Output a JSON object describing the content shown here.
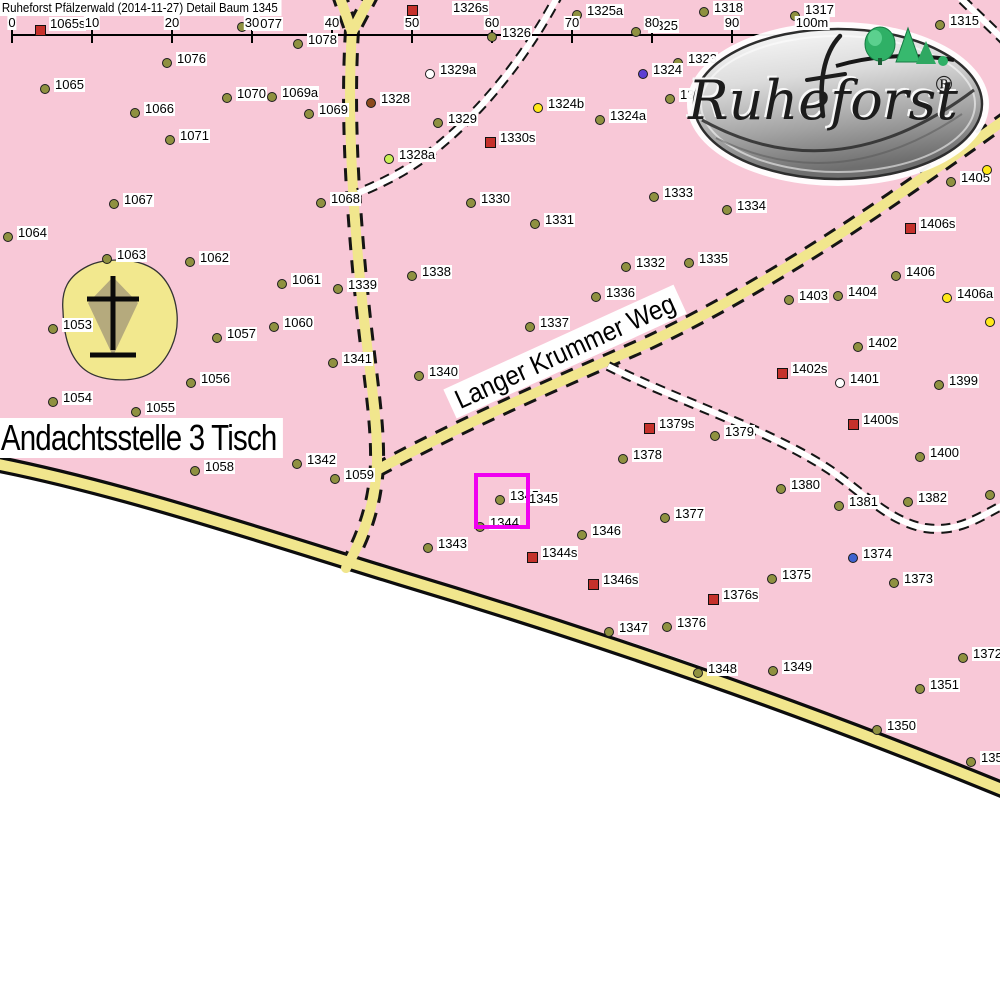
{
  "header": {
    "title": "Ruheforst Pfälzerwald (2014-11-27) Detail  Baum 1345"
  },
  "labels": {
    "place": "Andachtsstelle 3 Tisch",
    "street": "Langer Krummer Weg"
  },
  "logo": {
    "brand": "Ruheforst",
    "registered": "®"
  },
  "selected_tree": "1345",
  "highlight_box": {
    "x": 474,
    "y": 473,
    "w": 48,
    "h": 48,
    "color": "#f000f0"
  },
  "colors": {
    "forest_fill": "#f8c8d7",
    "road_fill": "#f1e68d",
    "highlight": "#f000f0",
    "label_bg": "#ffffff",
    "marker_colors": {
      "t": "#8f9140",
      "s": "#c5312b",
      "y": "#ffe81a",
      "yg": "#c9ef55",
      "w": "#ffffff",
      "br": "#8b4a1c",
      "pu": "#5d3fd3",
      "bl": "#3f63cf"
    }
  },
  "scalebar": {
    "line": {
      "x1": 12,
      "x2": 812,
      "y": 34
    },
    "ticks": [
      {
        "label": "0",
        "x": 12
      },
      {
        "label": "10",
        "x": 92
      },
      {
        "label": "20",
        "x": 172
      },
      {
        "label": "30",
        "x": 252
      },
      {
        "label": "40",
        "x": 332
      },
      {
        "label": "50",
        "x": 412
      },
      {
        "label": "60",
        "x": 492
      },
      {
        "label": "70",
        "x": 572
      },
      {
        "label": "80",
        "x": 652
      },
      {
        "label": "90",
        "x": 732
      },
      {
        "label": "100m",
        "x": 812
      }
    ]
  },
  "trees": [
    {
      "id": "1065s",
      "x": 40,
      "y": 30,
      "t": "s",
      "lx": 49,
      "ly": 17
    },
    {
      "id": "1077",
      "x": 242,
      "y": 27,
      "t": "t",
      "lx": 252,
      "ly": 17
    },
    {
      "id": "1078",
      "x": 298,
      "y": 44,
      "t": "t"
    },
    {
      "id": "1076",
      "x": 167,
      "y": 63,
      "t": "t"
    },
    {
      "id": "1065",
      "x": 45,
      "y": 89,
      "t": "t"
    },
    {
      "id": "1066",
      "x": 135,
      "y": 113,
      "t": "t"
    },
    {
      "id": "1070",
      "x": 227,
      "y": 98,
      "t": "t"
    },
    {
      "id": "1069a",
      "x": 272,
      "y": 97,
      "t": "t"
    },
    {
      "id": "1069",
      "x": 309,
      "y": 114,
      "t": "t"
    },
    {
      "id": "1071",
      "x": 170,
      "y": 140,
      "t": "t"
    },
    {
      "id": "1067",
      "x": 114,
      "y": 204,
      "t": "t"
    },
    {
      "id": "1064",
      "x": 8,
      "y": 237,
      "t": "t"
    },
    {
      "id": "1063",
      "x": 107,
      "y": 259,
      "t": "t"
    },
    {
      "id": "1062",
      "x": 190,
      "y": 262,
      "t": "t"
    },
    {
      "id": "1061",
      "x": 282,
      "y": 284,
      "t": "t"
    },
    {
      "id": "1060",
      "x": 274,
      "y": 327,
      "t": "t"
    },
    {
      "id": "1053",
      "x": 53,
      "y": 329,
      "t": "t"
    },
    {
      "id": "1057",
      "x": 217,
      "y": 338,
      "t": "t"
    },
    {
      "id": "1056",
      "x": 191,
      "y": 383,
      "t": "t"
    },
    {
      "id": "1054",
      "x": 53,
      "y": 402,
      "t": "t"
    },
    {
      "id": "1055",
      "x": 136,
      "y": 412,
      "t": "t"
    },
    {
      "id": "1058",
      "x": 195,
      "y": 471,
      "t": "t"
    },
    {
      "id": "1342",
      "x": 297,
      "y": 464,
      "t": "t"
    },
    {
      "id": "1059",
      "x": 335,
      "y": 479,
      "t": "t"
    },
    {
      "id": "1326s",
      "x": 412,
      "y": 10,
      "t": "s",
      "lx": 452,
      "ly": 1
    },
    {
      "id": "1326",
      "x": 492,
      "y": 37,
      "t": "t"
    },
    {
      "id": "1329a",
      "x": 430,
      "y": 74,
      "t": "w"
    },
    {
      "id": "1328",
      "x": 371,
      "y": 103,
      "t": "br"
    },
    {
      "id": "1329",
      "x": 438,
      "y": 123,
      "t": "t"
    },
    {
      "id": "1324b",
      "x": 538,
      "y": 108,
      "t": "y"
    },
    {
      "id": "1330s",
      "x": 490,
      "y": 142,
      "t": "s"
    },
    {
      "id": "1328a",
      "x": 389,
      "y": 159,
      "t": "yg"
    },
    {
      "id": "1068",
      "x": 321,
      "y": 203,
      "t": "t"
    },
    {
      "id": "1330",
      "x": 471,
      "y": 203,
      "t": "t"
    },
    {
      "id": "1331",
      "x": 535,
      "y": 224,
      "t": "t"
    },
    {
      "id": "1325a",
      "x": 577,
      "y": 15,
      "t": "t"
    },
    {
      "id": "1325",
      "x": 636,
      "y": 32,
      "t": "t",
      "lx": 648,
      "ly": 19
    },
    {
      "id": "1318",
      "x": 704,
      "y": 12,
      "t": "t"
    },
    {
      "id": "1317",
      "x": 795,
      "y": 16,
      "t": "t",
      "lx": 804,
      "ly": 3
    },
    {
      "id": "1315",
      "x": 940,
      "y": 25,
      "t": "t"
    },
    {
      "id": "1323",
      "x": 678,
      "y": 63,
      "t": "t"
    },
    {
      "id": "1324",
      "x": 643,
      "y": 74,
      "t": "pu"
    },
    {
      "id": "1321",
      "x": 670,
      "y": 99,
      "t": "t"
    },
    {
      "id": "1324a",
      "x": 600,
      "y": 120,
      "t": "t"
    },
    {
      "id": "1333",
      "x": 654,
      "y": 197,
      "t": "t"
    },
    {
      "id": "1334",
      "x": 727,
      "y": 210,
      "t": "t"
    },
    {
      "id": "1405",
      "x": 951,
      "y": 182,
      "t": "t"
    },
    {
      "id": "",
      "x": 987,
      "y": 170,
      "t": "y"
    },
    {
      "id": "1406s",
      "x": 910,
      "y": 228,
      "t": "s"
    },
    {
      "id": "1332",
      "x": 626,
      "y": 267,
      "t": "t"
    },
    {
      "id": "1335",
      "x": 689,
      "y": 263,
      "t": "t"
    },
    {
      "id": "1338",
      "x": 412,
      "y": 276,
      "t": "t"
    },
    {
      "id": "1339",
      "x": 338,
      "y": 289,
      "t": "t"
    },
    {
      "id": "1336",
      "x": 596,
      "y": 297,
      "t": "t"
    },
    {
      "id": "1406",
      "x": 896,
      "y": 276,
      "t": "t"
    },
    {
      "id": "1403",
      "x": 789,
      "y": 300,
      "t": "t"
    },
    {
      "id": "1404",
      "x": 838,
      "y": 296,
      "t": "t"
    },
    {
      "id": "1406a",
      "x": 947,
      "y": 298,
      "t": "y"
    },
    {
      "id": "",
      "x": 990,
      "y": 322,
      "t": "y"
    },
    {
      "id": "1337",
      "x": 530,
      "y": 327,
      "t": "t"
    },
    {
      "id": "1402",
      "x": 858,
      "y": 347,
      "t": "t"
    },
    {
      "id": "1341",
      "x": 333,
      "y": 363,
      "t": "t"
    },
    {
      "id": "1340",
      "x": 419,
      "y": 376,
      "t": "t"
    },
    {
      "id": "1402s",
      "x": 782,
      "y": 373,
      "t": "s"
    },
    {
      "id": "1401",
      "x": 840,
      "y": 383,
      "t": "w"
    },
    {
      "id": "1399",
      "x": 939,
      "y": 385,
      "t": "t"
    },
    {
      "id": "1379s",
      "x": 649,
      "y": 428,
      "t": "s"
    },
    {
      "id": "1379",
      "x": 715,
      "y": 436,
      "t": "t"
    },
    {
      "id": "1400s",
      "x": 853,
      "y": 424,
      "t": "s"
    },
    {
      "id": "1378",
      "x": 623,
      "y": 459,
      "t": "t"
    },
    {
      "id": "1400",
      "x": 920,
      "y": 457,
      "t": "t"
    },
    {
      "id": "1380",
      "x": 781,
      "y": 489,
      "t": "t"
    },
    {
      "id": "1381",
      "x": 839,
      "y": 506,
      "t": "t"
    },
    {
      "id": "1382",
      "x": 908,
      "y": 502,
      "t": "t"
    },
    {
      "id": "",
      "x": 990,
      "y": 495,
      "t": "t"
    },
    {
      "id": "1343",
      "x": 428,
      "y": 548,
      "t": "t"
    },
    {
      "id": "1344",
      "x": 480,
      "y": 527,
      "t": "t"
    },
    {
      "id": "1345",
      "x": 500,
      "y": 500,
      "t": "t"
    },
    {
      "id": "1346",
      "x": 582,
      "y": 535,
      "t": "t"
    },
    {
      "id": "1344s",
      "x": 532,
      "y": 557,
      "t": "s"
    },
    {
      "id": "1346s",
      "x": 593,
      "y": 584,
      "t": "s"
    },
    {
      "id": "1377",
      "x": 665,
      "y": 518,
      "t": "t"
    },
    {
      "id": "1375",
      "x": 772,
      "y": 579,
      "t": "t"
    },
    {
      "id": "1374",
      "x": 853,
      "y": 558,
      "t": "bl"
    },
    {
      "id": "1373",
      "x": 894,
      "y": 583,
      "t": "t"
    },
    {
      "id": "1376s",
      "x": 713,
      "y": 599,
      "t": "s"
    },
    {
      "id": "1376",
      "x": 667,
      "y": 627,
      "t": "t"
    },
    {
      "id": "1347",
      "x": 609,
      "y": 632,
      "t": "t"
    },
    {
      "id": "1348",
      "x": 698,
      "y": 673,
      "t": "t"
    },
    {
      "id": "1349",
      "x": 773,
      "y": 671,
      "t": "t"
    },
    {
      "id": "1372",
      "x": 963,
      "y": 658,
      "t": "t"
    },
    {
      "id": "1351",
      "x": 920,
      "y": 689,
      "t": "t"
    },
    {
      "id": "1350",
      "x": 877,
      "y": 730,
      "t": "t"
    },
    {
      "id": "1352",
      "x": 971,
      "y": 762,
      "t": "t"
    }
  ],
  "extra_labels": [
    {
      "text": "1345",
      "x": 528,
      "y": 492
    }
  ]
}
